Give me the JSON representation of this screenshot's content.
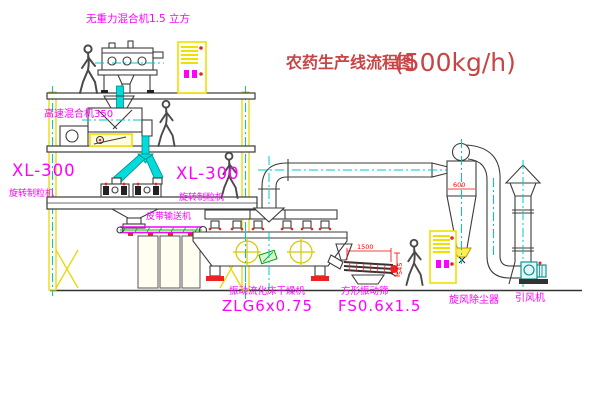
{
  "diagram": {
    "title": "农药生产线流程图",
    "capacity": "(500kg/h)",
    "equipment": {
      "gravity_mixer": {
        "label": "无重力混合机1.5 立方"
      },
      "high_speed_mixer": {
        "label": "高速混合机350"
      },
      "granulator_left": {
        "model": "XL-300",
        "name": "旋转制粒机"
      },
      "granulator_center": {
        "model": "XL-300",
        "name": "旋转制粒机"
      },
      "belt_conveyor": {
        "label": "皮带输送机"
      },
      "fluid_bed_dryer": {
        "name": "振动流化床干燥机",
        "model": "ZLG6x0.75"
      },
      "vibrating_screen": {
        "name": "方形振动筛",
        "model": "FS0.6x1.5",
        "dim_length": "1500",
        "dim_height": "545"
      },
      "cyclone": {
        "label": "旋风除尘器",
        "dim_diameter": "600"
      },
      "induced_draft_fan": {
        "label": "引风机"
      }
    },
    "colors": {
      "label_magenta": "#ff00ff",
      "title_red": "#c94444",
      "dimension_red": "#ff0000",
      "structure_yellow": "#e8d800",
      "centerline_cyan": "#00c8c8",
      "machine_dark": "#3c3c3c",
      "fan_teal": "#008b8b"
    }
  }
}
